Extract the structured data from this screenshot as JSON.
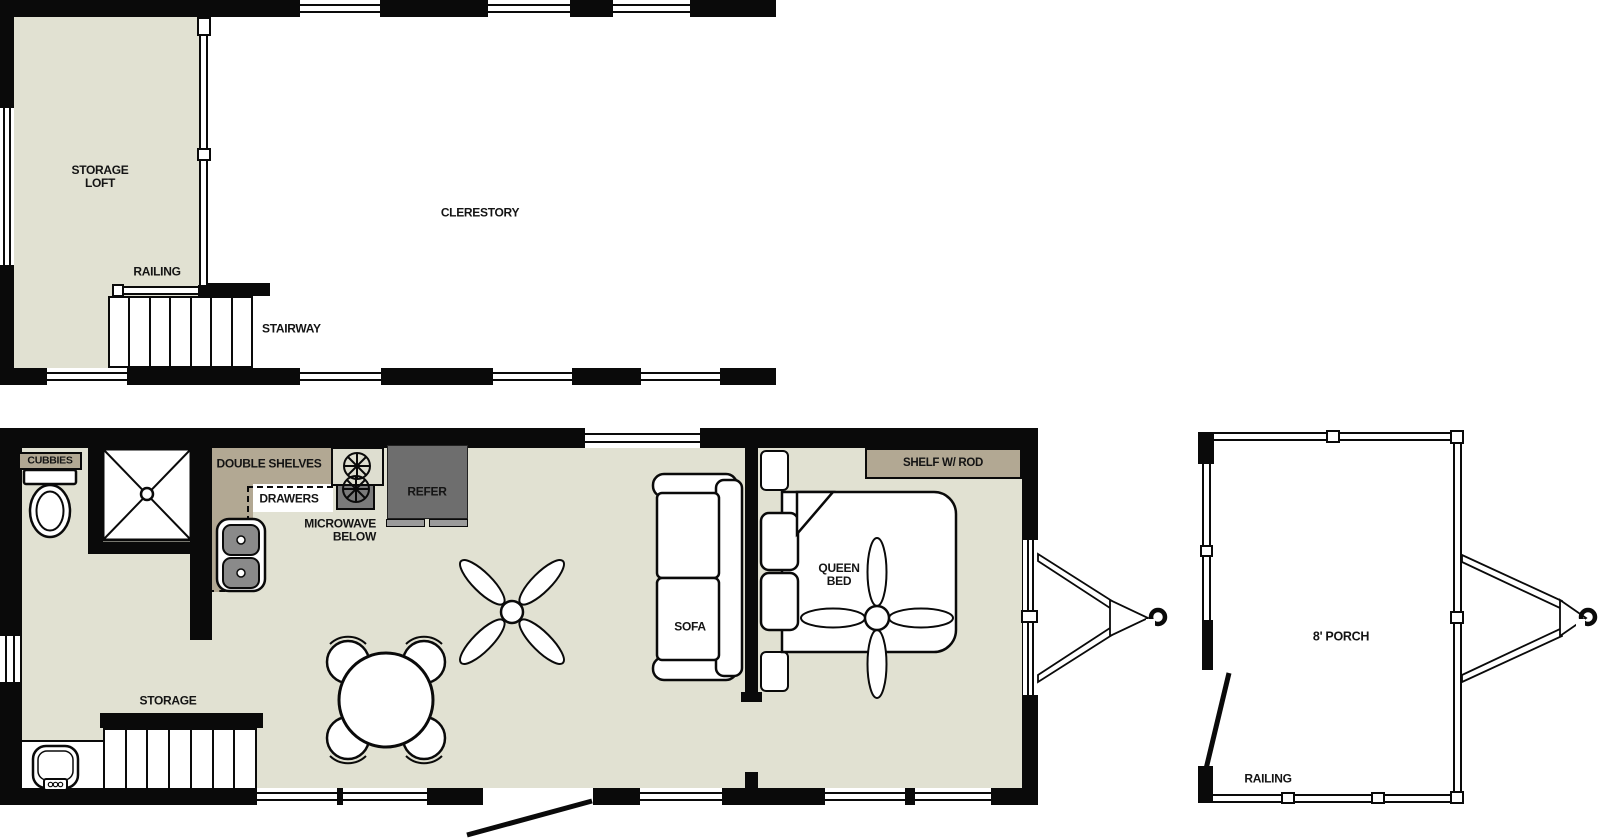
{
  "document": {
    "type": "floor-plan",
    "plans": [
      "loft",
      "main-floor",
      "porch"
    ]
  },
  "colors": {
    "floor": "#e1e1d2",
    "counter": "#b2a893",
    "wall": "#0a0a0a",
    "appliance_dark": "#6e6e6e",
    "appliance_light": "#9b9b9b",
    "sink_basin": "#8a8a8a"
  },
  "loft": {
    "labels": {
      "storage1": "STORAGE",
      "storage2": "LOFT",
      "railing": "RAILING",
      "stairway": "STAIRWAY",
      "clerestory": "CLERESTORY"
    }
  },
  "main": {
    "labels": {
      "cubbies": "CUBBIES",
      "double_shelves": "DOUBLE SHELVES",
      "drawers": "DRAWERS",
      "microwave1": "MICROWAVE",
      "microwave2": "BELOW",
      "refer": "REFER",
      "storage": "STORAGE",
      "sofa": "SOFA",
      "queen1": "QUEEN",
      "queen2": "BED",
      "shelf_rod": "SHELF W/ ROD"
    }
  },
  "porch": {
    "labels": {
      "name": "8' PORCH",
      "railing": "RAILING"
    }
  }
}
